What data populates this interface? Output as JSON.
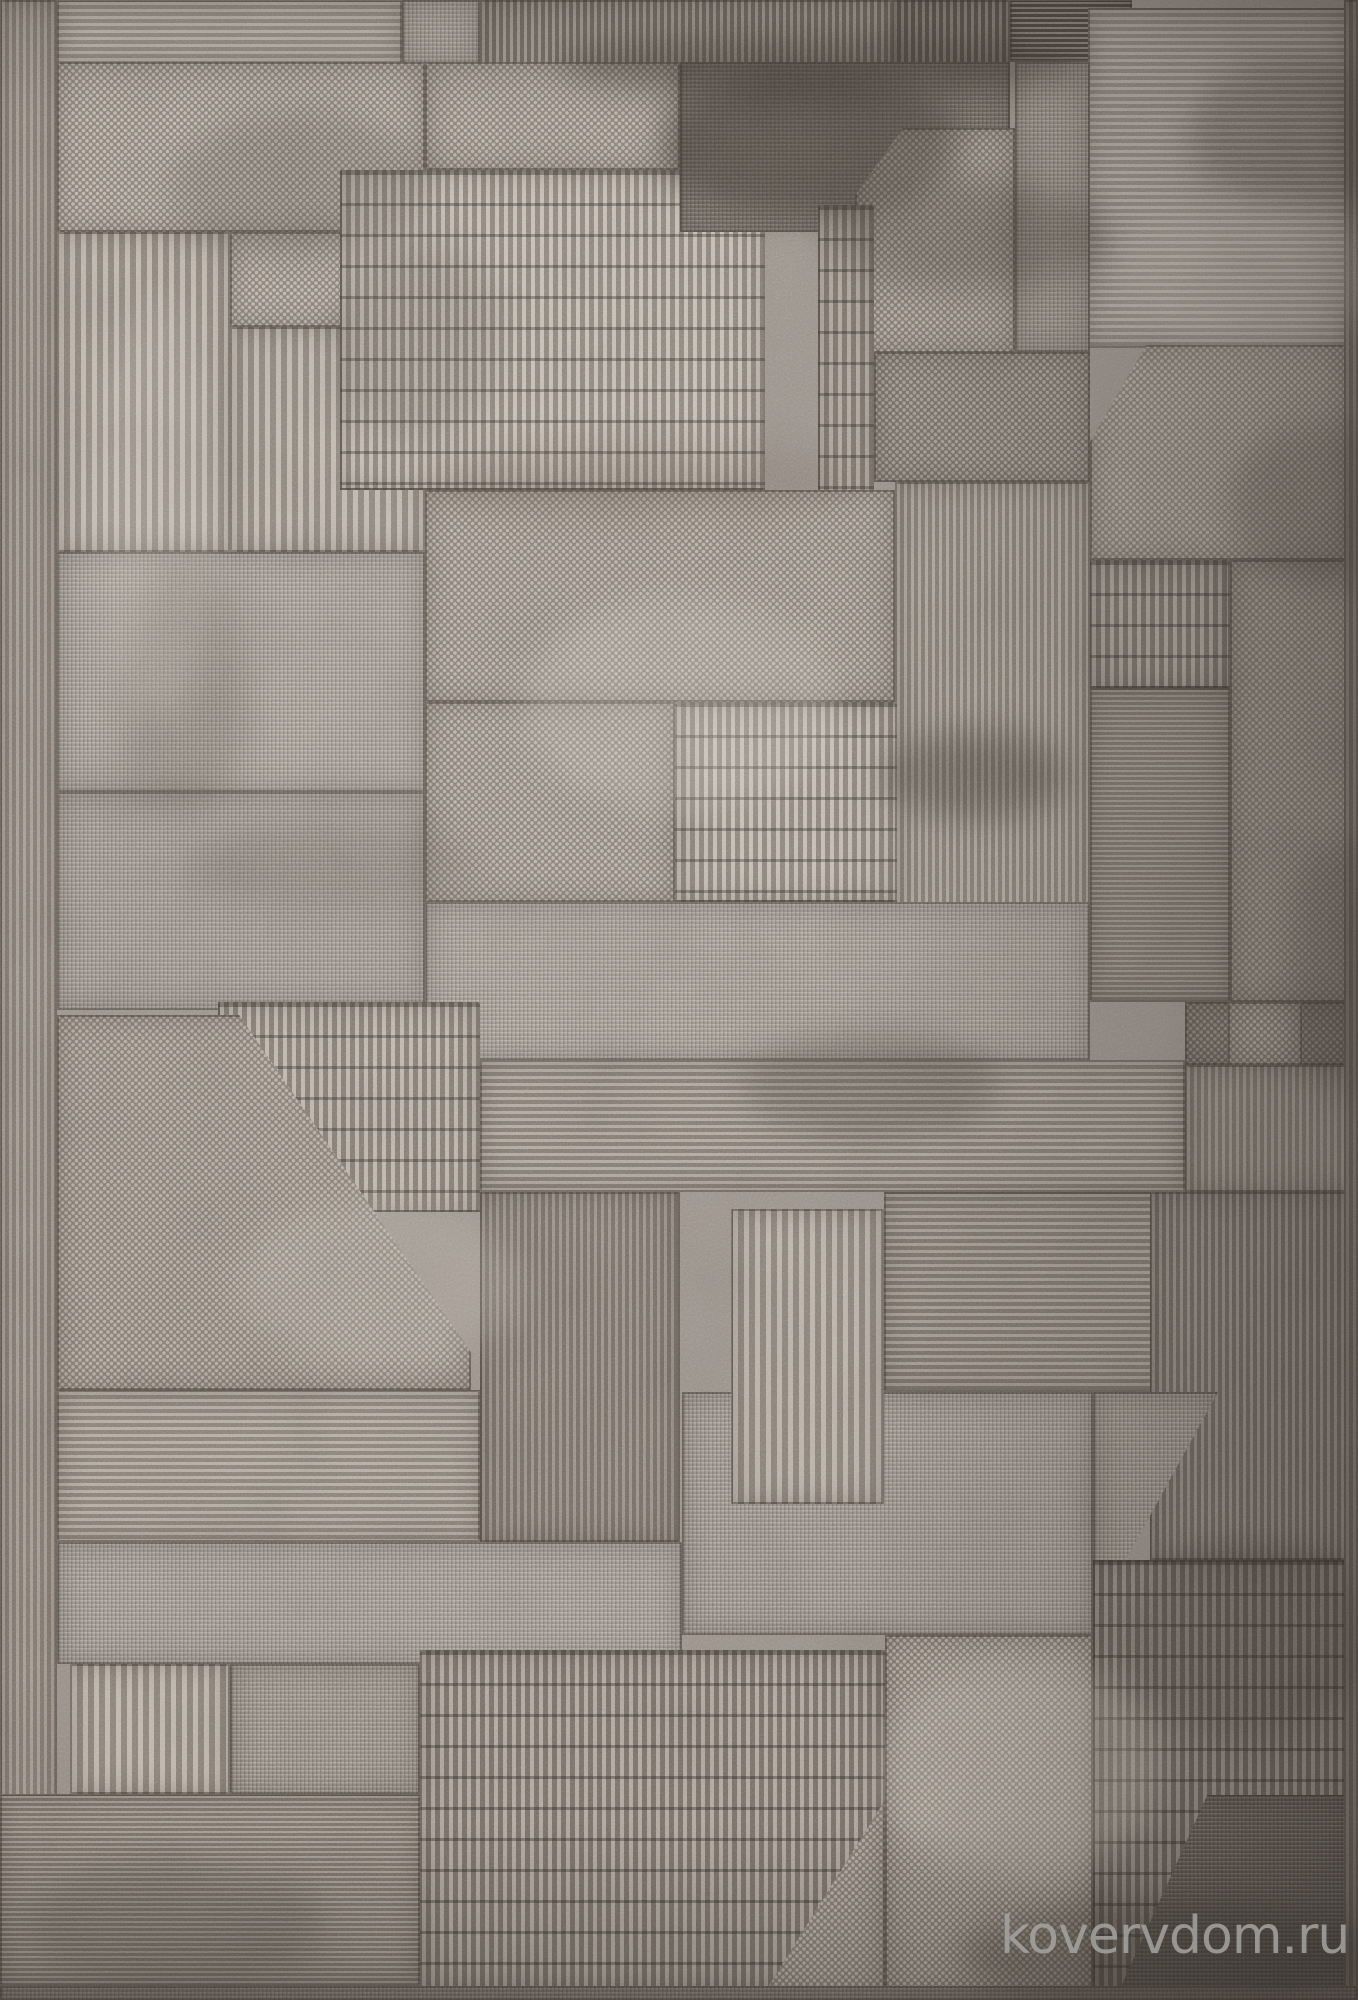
{
  "image": {
    "subject": "top view photo of a gray-taupe pile rug with abstract geometric patchwork pattern",
    "width_px": 1358,
    "height_px": 2000
  },
  "watermark": {
    "text": "kovervdom.ru",
    "color": "#a6a4a1"
  },
  "palette": {
    "base": "#9a9189",
    "light_bar": "#c7beb4",
    "light": "#b8afa5",
    "mid": "#a69d94",
    "mid_dark": "#847b72",
    "dark": "#665e56",
    "seam": "#3a342e",
    "corner_dark": "#443f39"
  },
  "rug": {
    "patches": [
      {
        "id": "left-edge",
        "x": 0,
        "y": 0,
        "w": 57,
        "h": 2000,
        "tex": "vrib",
        "l": "#a89f96",
        "d": "#847b72"
      },
      {
        "id": "top-hlines-left",
        "x": 57,
        "y": 0,
        "w": 345,
        "h": 64,
        "tex": "hline",
        "l": "#beb5ab",
        "d": "#948b82"
      },
      {
        "id": "top-knit-gap",
        "x": 402,
        "y": 0,
        "w": 78,
        "h": 64,
        "tex": "knit",
        "l": "#b3aaa1",
        "d": "#968d84"
      },
      {
        "id": "top-vribs-band",
        "x": 480,
        "y": 0,
        "w": 412,
        "h": 86,
        "tex": "vrib",
        "l": "#a0978e",
        "d": "#6e665e"
      },
      {
        "id": "top-vribs-dark",
        "x": 892,
        "y": 0,
        "w": 118,
        "h": 86,
        "tex": "vrib",
        "l": "#8a8279",
        "d": "#5a534c"
      },
      {
        "id": "top-hlines-dark",
        "x": 1010,
        "y": 0,
        "w": 122,
        "h": 62,
        "tex": "hline_f",
        "l": "#8d857d",
        "d": "#4e4842"
      },
      {
        "id": "tr-hlines-block",
        "x": 1088,
        "y": 8,
        "w": 258,
        "h": 340,
        "tex": "hline",
        "l": "#b7aea4",
        "d": "#908780"
      },
      {
        "id": "dotted-L-upper",
        "x": 57,
        "y": 62,
        "w": 368,
        "h": 170,
        "tex": "dots",
        "l": "#c4bbb1",
        "d": "#8a8178"
      },
      {
        "id": "dotted-L-lower",
        "x": 230,
        "y": 232,
        "w": 195,
        "h": 95,
        "tex": "dots",
        "l": "#c4bbb1",
        "d": "#8a8178"
      },
      {
        "id": "left-vstripes-a",
        "x": 57,
        "y": 232,
        "w": 173,
        "h": 320,
        "tex": "vribB",
        "l": "#c1b8ae",
        "d": "#8d847b"
      },
      {
        "id": "left-vstripes-b",
        "x": 230,
        "y": 327,
        "w": 195,
        "h": 225,
        "tex": "vribB",
        "l": "#c1b8ae",
        "d": "#8d847b"
      },
      {
        "id": "dots-center-top",
        "x": 425,
        "y": 62,
        "w": 255,
        "h": 108,
        "tex": "dots",
        "l": "#bfb6ac",
        "d": "#877e75"
      },
      {
        "id": "brick-block",
        "x": 340,
        "y": 170,
        "w": 425,
        "h": 320,
        "tex": "dash",
        "l": "#c7beb4",
        "d": "#8d847b"
      },
      {
        "id": "dark-patch",
        "x": 680,
        "y": 62,
        "w": 330,
        "h": 170,
        "tex": "knit",
        "l": "#7d756d",
        "d": "#544d46",
        "clip": "polygon(0 0,100% 0,100% 52%,58% 100%,0 100%)"
      },
      {
        "id": "pent-dots-ctr",
        "x": 855,
        "y": 128,
        "w": 160,
        "h": 225,
        "tex": "dots",
        "l": "#b9b0a6",
        "d": "#827970",
        "clip": "polygon(30% 0,100% 0,100% 100%,0 100%,0 30%)"
      },
      {
        "id": "knit-strip-r",
        "x": 1015,
        "y": 62,
        "w": 75,
        "h": 290,
        "tex": "knit",
        "l": "#a1988f",
        "d": "#7d746b"
      },
      {
        "id": "dash-strip",
        "x": 818,
        "y": 205,
        "w": 56,
        "h": 300,
        "tex": "dash",
        "l": "#b4aba1",
        "d": "#7e756c"
      },
      {
        "id": "knit-band-mid",
        "x": 874,
        "y": 352,
        "w": 216,
        "h": 130,
        "tex": "dots",
        "l": "#a79e95",
        "d": "#736b63"
      },
      {
        "id": "ctr-right-vribs",
        "x": 895,
        "y": 482,
        "w": 195,
        "h": 520,
        "tex": "vrib",
        "l": "#b1a89e",
        "d": "#847b72"
      },
      {
        "id": "pent-dots-right",
        "x": 1090,
        "y": 345,
        "w": 256,
        "h": 215,
        "tex": "dots",
        "l": "#b4aba1",
        "d": "#847b72",
        "clip": "polygon(0 45%,22% 0,100% 0,100% 100%,0 100%)"
      },
      {
        "id": "dash-right-mid",
        "x": 1090,
        "y": 560,
        "w": 140,
        "h": 128,
        "tex": "dash",
        "l": "#a9a097",
        "d": "#766e66"
      },
      {
        "id": "hlines-right-mid",
        "x": 1090,
        "y": 688,
        "w": 140,
        "h": 314,
        "tex": "hline_f",
        "l": "#9e958c",
        "d": "#7a7168"
      },
      {
        "id": "dots-right-col",
        "x": 1230,
        "y": 560,
        "w": 128,
        "h": 442,
        "tex": "dots",
        "l": "#a69d94",
        "d": "#7c736a"
      },
      {
        "id": "knit-ml-a",
        "x": 57,
        "y": 552,
        "w": 368,
        "h": 240,
        "tex": "knit",
        "l": "#b2a9a0",
        "d": "#8e857c"
      },
      {
        "id": "knit-ml-b",
        "x": 57,
        "y": 792,
        "w": 368,
        "h": 218,
        "tex": "knit",
        "l": "#aba29a",
        "d": "#877e75"
      },
      {
        "id": "dots-center",
        "x": 425,
        "y": 490,
        "w": 470,
        "h": 212,
        "tex": "dots",
        "l": "#bcb3a9",
        "d": "#847b72"
      },
      {
        "id": "dots-center-b",
        "x": 425,
        "y": 702,
        "w": 250,
        "h": 200,
        "tex": "dots",
        "l": "#bcb3a9",
        "d": "#847b72"
      },
      {
        "id": "dash-center",
        "x": 675,
        "y": 702,
        "w": 222,
        "h": 200,
        "tex": "dash",
        "l": "#c5bcb2",
        "d": "#8a8178"
      },
      {
        "id": "knit-band-ctr",
        "x": 425,
        "y": 902,
        "w": 665,
        "h": 158,
        "tex": "knit",
        "l": "#afa69d",
        "d": "#847b72"
      },
      {
        "id": "hlines-wide",
        "x": 480,
        "y": 1060,
        "w": 705,
        "h": 132,
        "tex": "hline",
        "l": "#b0a79e",
        "d": "#827970"
      },
      {
        "id": "dash-left-ctr",
        "x": 218,
        "y": 1002,
        "w": 262,
        "h": 210,
        "tex": "dash",
        "l": "#beb5ab",
        "d": "#837a71"
      },
      {
        "id": "pent-dots-left",
        "x": 57,
        "y": 1015,
        "w": 414,
        "h": 375,
        "tex": "dots",
        "l": "#b8afa5",
        "d": "#847b72",
        "clip": "polygon(0 0,44% 0,100% 90%,100% 100%,0 100%)"
      },
      {
        "id": "hlines-left-low",
        "x": 57,
        "y": 1390,
        "w": 423,
        "h": 152,
        "tex": "hline",
        "l": "#b6ada3",
        "d": "#8a8178"
      },
      {
        "id": "vribs-ctr-low",
        "x": 480,
        "y": 1192,
        "w": 200,
        "h": 350,
        "tex": "vrib",
        "l": "#9a9188",
        "d": "#766d65"
      },
      {
        "id": "hlines-right-low",
        "x": 884,
        "y": 1192,
        "w": 301,
        "h": 200,
        "tex": "hline",
        "l": "#a89f96",
        "d": "#7d746b"
      },
      {
        "id": "knit-low-ctr",
        "x": 682,
        "y": 1392,
        "w": 411,
        "h": 243,
        "tex": "knit",
        "l": "#aaa199",
        "d": "#827970"
      },
      {
        "id": "vstripes-low",
        "x": 731,
        "y": 1209,
        "w": 153,
        "h": 295,
        "tex": "vribB",
        "l": "#bcb3a9",
        "d": "#8a8178"
      },
      {
        "id": "knit-band-left",
        "x": 57,
        "y": 1542,
        "w": 625,
        "h": 122,
        "tex": "knit",
        "l": "#b1a8a0",
        "d": "#8c837a"
      },
      {
        "id": "vstripes-bl",
        "x": 70,
        "y": 1664,
        "w": 160,
        "h": 130,
        "tex": "vribB",
        "l": "#c1b8ae",
        "d": "#8d847b"
      },
      {
        "id": "knit-bl",
        "x": 230,
        "y": 1664,
        "w": 190,
        "h": 130,
        "tex": "knit",
        "l": "#a79e95",
        "d": "#847b72"
      },
      {
        "id": "hribs-bottom",
        "x": 0,
        "y": 1794,
        "w": 420,
        "h": 192,
        "tex": "hline_f",
        "l": "#a9a097",
        "d": "#7e756c"
      },
      {
        "id": "dash-bottom",
        "x": 420,
        "y": 1650,
        "w": 465,
        "h": 340,
        "tex": "dash",
        "l": "#b2a9a0",
        "d": "#7a7169"
      },
      {
        "id": "dots-tri",
        "x": 760,
        "y": 1800,
        "w": 125,
        "h": 200,
        "tex": "dots",
        "l": "#bbb2a8",
        "d": "#847b72",
        "clip": "polygon(100% 0,100% 100%,0 100%)"
      },
      {
        "id": "dots-bottom",
        "x": 885,
        "y": 1635,
        "w": 208,
        "h": 365,
        "tex": "dots",
        "l": "#bdb4aa",
        "d": "#847b72"
      },
      {
        "id": "dots-rc-dark",
        "x": 1185,
        "y": 1002,
        "w": 173,
        "h": 63,
        "tex": "dots",
        "l": "#948b82",
        "d": "#6a625a"
      },
      {
        "id": "dots-rc-sq",
        "x": 1228,
        "y": 1002,
        "w": 74,
        "h": 63,
        "tex": "dots",
        "l": "#b3aaa0",
        "d": "#7f766d"
      },
      {
        "id": "vribs-rc",
        "x": 1185,
        "y": 1065,
        "w": 173,
        "h": 127,
        "tex": "vrib",
        "l": "#a1988f",
        "d": "#7c746b"
      },
      {
        "id": "vribs-rc-big",
        "x": 1150,
        "y": 1192,
        "w": 208,
        "h": 368,
        "tex": "vrib",
        "l": "#958c83",
        "d": "#6e665f"
      },
      {
        "id": "knit-tri-rc",
        "x": 1093,
        "y": 1392,
        "w": 125,
        "h": 200,
        "tex": "knit",
        "l": "#a39a91",
        "d": "#7a7168",
        "clip": "polygon(0 0,100% 0,12% 100%,0 100%)"
      },
      {
        "id": "dash-br",
        "x": 1093,
        "y": 1560,
        "w": 265,
        "h": 440,
        "tex": "dash",
        "l": "#999088",
        "d": "#6a625b"
      },
      {
        "id": "dark-corner",
        "x": 1115,
        "y": 1795,
        "w": 243,
        "h": 205,
        "tex": "knit",
        "l": "#6a635c",
        "d": "#443f39",
        "clip": "polygon(38% 0,100% 0,100% 100%,0 100%)"
      },
      {
        "id": "right-edge",
        "x": 1344,
        "y": 0,
        "w": 14,
        "h": 2000,
        "tex": "vrib",
        "l": "#999087",
        "d": "#756d65"
      },
      {
        "id": "bottom-edge",
        "x": 0,
        "y": 1986,
        "w": 1358,
        "h": 14,
        "tex": "knit",
        "l": "#8e857d",
        "d": "#6d655d"
      }
    ],
    "blotches": [
      {
        "x": 170,
        "y": 110,
        "w": 260,
        "h": 150,
        "c": "#4a443e",
        "o": 0.22
      },
      {
        "x": 330,
        "y": 240,
        "w": 170,
        "h": 200,
        "c": "#4a443e",
        "o": 0.18
      },
      {
        "x": 560,
        "y": 30,
        "w": 520,
        "h": 70,
        "c": "#39332d",
        "o": 0.4
      },
      {
        "x": 660,
        "y": 70,
        "w": 300,
        "h": 150,
        "c": "#3a342e",
        "o": 0.45
      },
      {
        "x": 830,
        "y": 180,
        "w": 280,
        "h": 110,
        "c": "#3f3933",
        "o": 0.3
      },
      {
        "x": 1190,
        "y": 60,
        "w": 220,
        "h": 150,
        "c": "#443f3a",
        "o": 0.3
      },
      {
        "x": 880,
        "y": 730,
        "w": 190,
        "h": 90,
        "c": "#423d37",
        "o": 0.4
      },
      {
        "x": 740,
        "y": 1030,
        "w": 260,
        "h": 110,
        "c": "#4c463f",
        "o": 0.3
      },
      {
        "x": 120,
        "y": 560,
        "w": 130,
        "h": 260,
        "c": "#5a5249",
        "o": 0.2
      },
      {
        "x": 1230,
        "y": 420,
        "w": 200,
        "h": 170,
        "c": "#4c4640",
        "o": 0.28
      },
      {
        "x": 420,
        "y": 440,
        "w": 430,
        "h": 80,
        "c": "#55463c",
        "o": 0.16
      },
      {
        "x": 180,
        "y": 820,
        "w": 300,
        "h": 90,
        "c": "#5d544b",
        "o": 0.2
      },
      {
        "x": 1290,
        "y": 840,
        "w": 100,
        "h": 260,
        "c": "#4a443f",
        "o": 0.26
      },
      {
        "x": 30,
        "y": 1860,
        "w": 300,
        "h": 130,
        "c": "#534d47",
        "o": 0.24
      },
      {
        "x": 960,
        "y": 1900,
        "w": 420,
        "h": 110,
        "c": "#3c3731",
        "o": 0.35
      },
      {
        "x": 1120,
        "y": 1540,
        "w": 250,
        "h": 200,
        "c": "#47423c",
        "o": 0.25
      },
      {
        "x": 520,
        "y": 600,
        "w": 320,
        "h": 210,
        "c": "#d8cfc5",
        "o": 0.22
      },
      {
        "x": 880,
        "y": 1660,
        "w": 280,
        "h": 220,
        "c": "#d5ccc1",
        "o": 0.26
      },
      {
        "x": 240,
        "y": 1200,
        "w": 280,
        "h": 170,
        "c": "#d1c8bd",
        "o": 0.2
      },
      {
        "x": 1120,
        "y": 200,
        "w": 260,
        "h": 150,
        "c": "#d2c9be",
        "o": 0.22
      },
      {
        "x": 90,
        "y": 300,
        "w": 130,
        "h": 420,
        "c": "#d8d0c6",
        "o": 0.18
      }
    ]
  }
}
